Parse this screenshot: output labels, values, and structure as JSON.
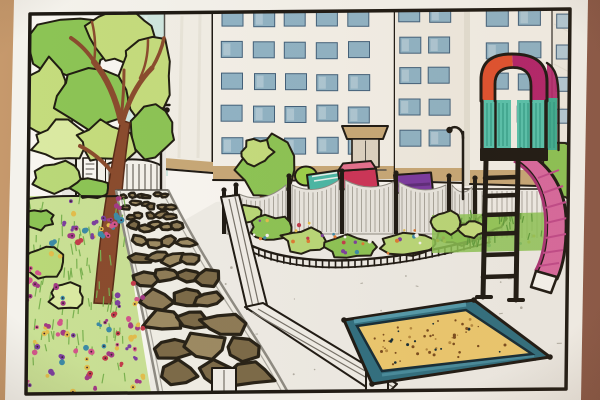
{
  "meta": {
    "title": "Hand-drawn park and playground illustration",
    "description": "Photographed marker-and-colored-pencil drawing of a city pocket park: a large leafy tree and flower beds on the left, a curved stone path leading from an entrance gate, a scalloped playground fence with a small tree, a pink slide tower with an orange and magenta arch, a teal-framed sandbox full of sand, and white high-rise buildings with grids of blue windows behind."
  },
  "palette": {
    "table_left": "#c6996c",
    "table_mid": "#ab7d56",
    "table_right": "#8a5847",
    "paper": "#f4f2ec",
    "paper_inner": "#f8f6f1",
    "frame_ink": "#1b1713",
    "ink": "#1d1913",
    "ink_soft": "#53504a",
    "sky": "#cfe6df",
    "sky_streak": "#e6f2ed",
    "wall_white": "#f1eee6",
    "face": "#f3f0e8",
    "face2": "#efebe1",
    "shade": "#e3dfd3",
    "window_blue": "#8fb3c5",
    "window_blue2": "#b3cad6",
    "window_edge": "#41607a",
    "base_tan": "#c7a877",
    "door": "#dcd3c2",
    "street": "#e9e7e1",
    "gate_white": "#f3f1ea",
    "gate_line": "#757169",
    "panel_gray": "#e8e6e0",
    "panel_line": "#a9a69d",
    "fence_white": "#f0eee8",
    "curb": "#8d8b83",
    "mortar": "#f0eee6",
    "stone_a": "#8d7b57",
    "stone_b": "#7b6a48",
    "stone_c": "#9c8a63",
    "stone_edge": "#262116",
    "ground": "#eeece6",
    "ground_speck": "#b1aea4",
    "grass_base": "#c9e095",
    "grass_stroke": "#79b150",
    "leaf_pale": "#daeaa2",
    "leaf_light": "#c4dc7d",
    "leaf_mid": "#8cc455",
    "leaf_dark": "#5f9c3c",
    "bush_light": "#b9d878",
    "blob_ink": "#201d12",
    "trunk": "#8a4b2e",
    "trunk_dark": "#592c18",
    "flower_pink": "#d2558b",
    "flower_magenta": "#a23a85",
    "flower_purple": "#7c3f9e",
    "flower_red": "#c23b4a",
    "flower_blue": "#3c8aa6",
    "flower_orange": "#de7a33",
    "flower_gold": "#e2bd4c",
    "flower_center": "#3a2030",
    "item_lime": "#9ccf4a",
    "item_teal": "#49b8a6",
    "item_stripe": "#e8f2ec",
    "item_red": "#cc3358",
    "item_red_light": "#e4708e",
    "item_purple": "#7a3aa0",
    "item_purple_dark": "#5c2b7a",
    "sand": "#ecc96f",
    "sand_speck": "#7a4c1e",
    "sand_speck2": "#b5893f",
    "box_teal": "#2f6f80",
    "box_teal_light": "#579fb0",
    "box_ink": "#132b36",
    "slide_pink": "#d9699f",
    "slide_pink_light": "#ea93bd",
    "slide_rail": "#a83374",
    "slide_shade": "#c14a8a",
    "arch_orange": "#e0512f",
    "arch_magenta": "#b3246b",
    "tower_teal": "#57c3ad",
    "tower_teal2": "#3fae92",
    "tower_stripe": "#2e9a84",
    "lamp_ink": "#24201a"
  },
  "scene": {
    "seed": 11,
    "window_grids": [
      {
        "layer": "bA",
        "x": 222,
        "y": 10,
        "cols": 5,
        "rows": 5,
        "w": 21,
        "h": 16,
        "dx": 31.5,
        "dy": 32,
        "fill": "window_blue"
      },
      {
        "layer": "bB",
        "x": 399,
        "y": 6,
        "cols": 2,
        "rows": 5,
        "w": 21,
        "h": 16,
        "dx": 30,
        "dy": 31,
        "fill": "window_blue"
      },
      {
        "layer": "bC",
        "x": 486,
        "y": 10,
        "cols": 2,
        "rows": 5,
        "w": 22,
        "h": 16,
        "dx": 32,
        "dy": 32,
        "fill": "window_blue"
      },
      {
        "layer": "bC",
        "x": 556,
        "y": 14,
        "cols": 1,
        "rows": 5,
        "w": 13,
        "h": 14,
        "dx": 1,
        "dy": 32,
        "fill": "window_blue2"
      }
    ],
    "gate_bars": {
      "x0": 109,
      "x1": 158,
      "step": 6,
      "ytop": 164,
      "ybot": 195
    },
    "swag_posts": [
      {
        "x": 224,
        "t": 194
      },
      {
        "x": 236,
        "t": 189
      },
      {
        "x": 289,
        "t": 180
      },
      {
        "x": 342,
        "t": 175
      },
      {
        "x": 396,
        "t": 177
      },
      {
        "x": 449,
        "t": 180
      },
      {
        "x": 475,
        "t": 182
      }
    ],
    "swag_bottom": 234,
    "tower_bays": [
      {
        "x": 485,
        "y": 101,
        "w": 25,
        "h": 47
      },
      {
        "x": 518,
        "y": 101,
        "w": 26,
        "h": 50
      },
      {
        "x": 548,
        "y": 100,
        "w": 9,
        "h": 50
      }
    ],
    "blobs": [
      {
        "layer": "foliage",
        "cx": 70,
        "cy": 48,
        "rx": 44,
        "ry": 34,
        "fill": "leaf_mid"
      },
      {
        "layer": "foliage",
        "cx": 124,
        "cy": 38,
        "rx": 38,
        "ry": 27,
        "fill": "leaf_light"
      },
      {
        "layer": "foliage",
        "cx": 44,
        "cy": 100,
        "rx": 28,
        "ry": 38,
        "fill": "leaf_light"
      },
      {
        "layer": "foliage",
        "cx": 97,
        "cy": 96,
        "rx": 40,
        "ry": 31,
        "fill": "leaf_mid"
      },
      {
        "layer": "foliage",
        "cx": 146,
        "cy": 76,
        "rx": 28,
        "ry": 40,
        "fill": "leaf_light"
      },
      {
        "layer": "foliage",
        "cx": 150,
        "cy": 132,
        "rx": 25,
        "ry": 24,
        "fill": "leaf_mid"
      },
      {
        "layer": "foliage",
        "cx": 62,
        "cy": 142,
        "rx": 30,
        "ry": 20,
        "fill": "leaf_pale"
      },
      {
        "layer": "foliage",
        "cx": 106,
        "cy": 142,
        "rx": 30,
        "ry": 21,
        "fill": "leaf_light"
      },
      {
        "layer": "underbush",
        "cx": 60,
        "cy": 178,
        "rx": 27,
        "ry": 15,
        "fill": "bush_light"
      },
      {
        "layer": "underbush",
        "cx": 92,
        "cy": 188,
        "rx": 20,
        "ry": 11,
        "fill": "leaf_mid"
      },
      {
        "layer": "leftbed",
        "cx": 42,
        "cy": 262,
        "rx": 22,
        "ry": 16,
        "fill": "bush_light"
      },
      {
        "layer": "leftbed",
        "cx": 67,
        "cy": 297,
        "rx": 18,
        "ry": 13,
        "fill": "leaf_pale"
      },
      {
        "layer": "leftbed",
        "cx": 38,
        "cy": 219,
        "rx": 15,
        "ry": 10,
        "fill": "leaf_mid"
      },
      {
        "layer": "smalltree",
        "cx": 267,
        "cy": 170,
        "rx": 29,
        "ry": 32,
        "fill": "leaf_mid"
      },
      {
        "layer": "smalltree",
        "cx": 257,
        "cy": 152,
        "rx": 16,
        "ry": 13,
        "fill": "leaf_light"
      },
      {
        "layer": "centerbed",
        "cx": 247,
        "cy": 214,
        "rx": 16,
        "ry": 10,
        "fill": "bush_light"
      },
      {
        "layer": "centerbed",
        "cx": 270,
        "cy": 227,
        "rx": 22,
        "ry": 12,
        "fill": "leaf_mid"
      },
      {
        "layer": "centerbed",
        "cx": 306,
        "cy": 241,
        "rx": 24,
        "ry": 12,
        "fill": "bush_light"
      },
      {
        "layer": "centerbed",
        "cx": 352,
        "cy": 247,
        "rx": 26,
        "ry": 11,
        "fill": "leaf_mid"
      },
      {
        "layer": "centerbed",
        "cx": 408,
        "cy": 244,
        "rx": 26,
        "ry": 11,
        "fill": "bush_light"
      },
      {
        "layer": "centerbed",
        "cx": 458,
        "cy": 233,
        "rx": 22,
        "ry": 11,
        "fill": "leaf_mid"
      },
      {
        "layer": "centerbed",
        "cx": 492,
        "cy": 222,
        "rx": 14,
        "ry": 9,
        "fill": "bush_light"
      },
      {
        "layer": "rightbush",
        "cx": 560,
        "cy": 170,
        "rx": 21,
        "ry": 36,
        "fill": "leaf_mid"
      },
      {
        "layer": "rightbush",
        "cx": 448,
        "cy": 222,
        "rx": 16,
        "ry": 11,
        "fill": "bush_light"
      },
      {
        "layer": "rightbush",
        "cx": 472,
        "cy": 229,
        "rx": 12,
        "ry": 8,
        "fill": "leaf_light"
      }
    ],
    "flower_colors": [
      "flower_pink",
      "flower_magenta",
      "flower_purple",
      "flower_red",
      "flower_blue",
      "flower_gold"
    ],
    "flower_clusters": [
      {
        "x": 58,
        "y": 198,
        "w": 64,
        "h": 46,
        "n": 26
      },
      {
        "x": 24,
        "y": 322,
        "w": 120,
        "h": 70,
        "n": 48
      },
      {
        "x": 24,
        "y": 238,
        "w": 42,
        "h": 66,
        "n": 12
      },
      {
        "x": 112,
        "y": 282,
        "w": 34,
        "h": 48,
        "n": 10
      }
    ],
    "garden_dot_colors": [
      "flower_orange",
      "flower_gold",
      "flower_red",
      "flower_blue",
      "paper",
      "flower_purple"
    ],
    "garden_dot_clusters": [
      {
        "x": 252,
        "y": 216,
        "w": 78,
        "h": 34,
        "n": 14
      },
      {
        "x": 330,
        "y": 228,
        "w": 86,
        "h": 26,
        "n": 15
      },
      {
        "x": 414,
        "y": 222,
        "w": 80,
        "h": 26,
        "n": 13
      },
      {
        "x": 436,
        "y": 212,
        "w": 120,
        "h": 34,
        "n": 10
      }
    ],
    "grass_regions": [
      {
        "layer": "grass-left",
        "x": 30,
        "y": 204,
        "w": 96,
        "h": 186,
        "n": 85,
        "len": 9,
        "color": "grass_stroke"
      },
      {
        "layer": "grass-right",
        "x": 433,
        "y": 216,
        "w": 122,
        "h": 32,
        "n": 34,
        "len": 7,
        "color": "leaf_dark"
      }
    ],
    "stone_path": {
      "left": [
        [
          116,
          190
        ],
        [
          126,
          240
        ],
        [
          138,
          292
        ],
        [
          150,
          345
        ],
        [
          160,
          400
        ]
      ],
      "right": [
        [
          168,
          190
        ],
        [
          198,
          242
        ],
        [
          228,
          295
        ],
        [
          258,
          345
        ],
        [
          292,
          400
        ]
      ],
      "rows": [
        {
          "y": 197,
          "n": 6,
          "r": 3.2
        },
        {
          "y": 205,
          "n": 6,
          "r": 3.8
        },
        {
          "y": 215,
          "n": 5,
          "r": 4.6
        },
        {
          "y": 227,
          "n": 5,
          "r": 5.6
        },
        {
          "y": 241,
          "n": 4,
          "r": 7
        },
        {
          "y": 258,
          "n": 4,
          "r": 8.6
        },
        {
          "y": 277,
          "n": 4,
          "r": 10.4
        },
        {
          "y": 298,
          "n": 3,
          "r": 12.5
        },
        {
          "y": 322,
          "n": 3,
          "r": 15
        },
        {
          "y": 348,
          "n": 3,
          "r": 17.5
        },
        {
          "y": 376,
          "n": 3,
          "r": 20
        }
      ]
    },
    "sandbox": {
      "outer": [
        [
          344,
          320
        ],
        [
          474,
          300
        ],
        [
          550,
          357
        ],
        [
          372,
          384
        ]
      ],
      "inner": [
        [
          357,
          326
        ],
        [
          466,
          310
        ],
        [
          532,
          354
        ],
        [
          382,
          371
        ]
      ],
      "n": 55
    },
    "ground_speckles": {
      "x": 158,
      "y": 252,
      "w": 400,
      "h": 134,
      "n": 48
    }
  }
}
